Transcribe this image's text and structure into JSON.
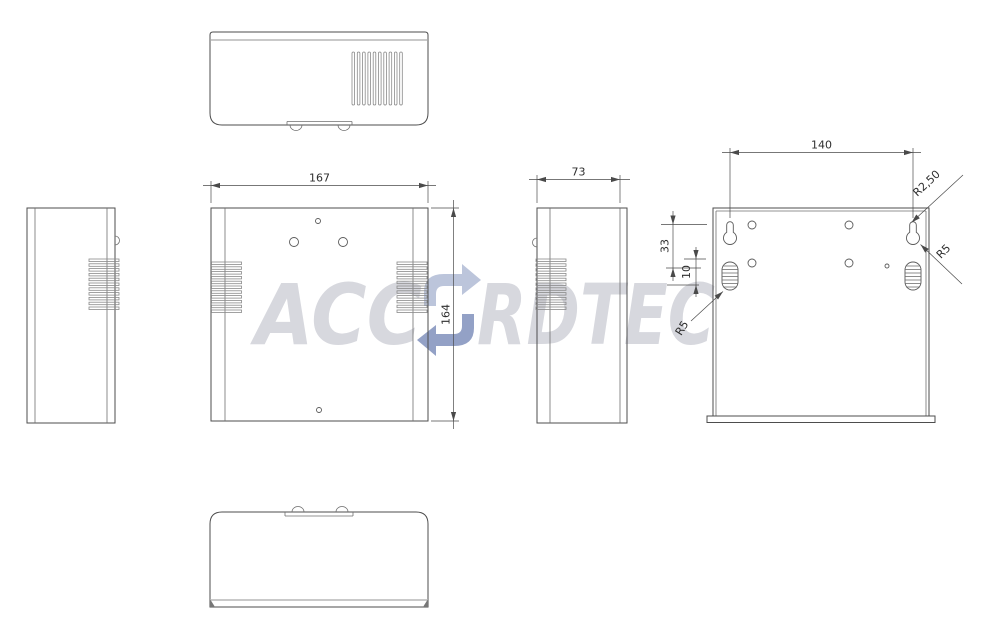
{
  "drawing": {
    "watermark": {
      "prefix": "ACC",
      "suffix": "RDTEC",
      "logo_icon": "circular-arrows-swirl",
      "text_color": "#d7d8de",
      "logo_color_light": "#bcc5db",
      "logo_color_dark": "#93a1c6"
    },
    "dimensions": {
      "front_width": "167",
      "front_height": "164",
      "side_depth": "73",
      "back_hole_spacing": "140",
      "back_keyhole_slot_radius": "R2,50",
      "back_keyhole_radius": "R5",
      "back_vent_radius": "R5",
      "back_keyhole_offset": "33",
      "back_vent_offset": "10"
    },
    "colors": {
      "line": "#4d4d4d",
      "dimension": "#4a4a4a",
      "vent": "#8a8a8a"
    }
  }
}
